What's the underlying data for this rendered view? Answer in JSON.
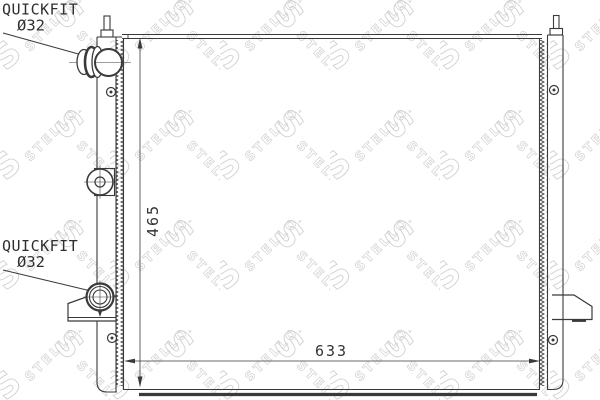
{
  "labels": {
    "quickfit_top": {
      "title": "QUICKFIT",
      "diameter": "Ø32"
    },
    "quickfit_bottom": {
      "title": "QUICKFIT",
      "diameter": "Ø32"
    }
  },
  "dimensions": {
    "height": "465",
    "width": "633"
  },
  "watermark": {
    "initial": "S",
    "text": "STELLOX"
  },
  "colors": {
    "line": "#3a3a3a",
    "watermark": "#c6c6c6",
    "background": "#ffffff"
  }
}
